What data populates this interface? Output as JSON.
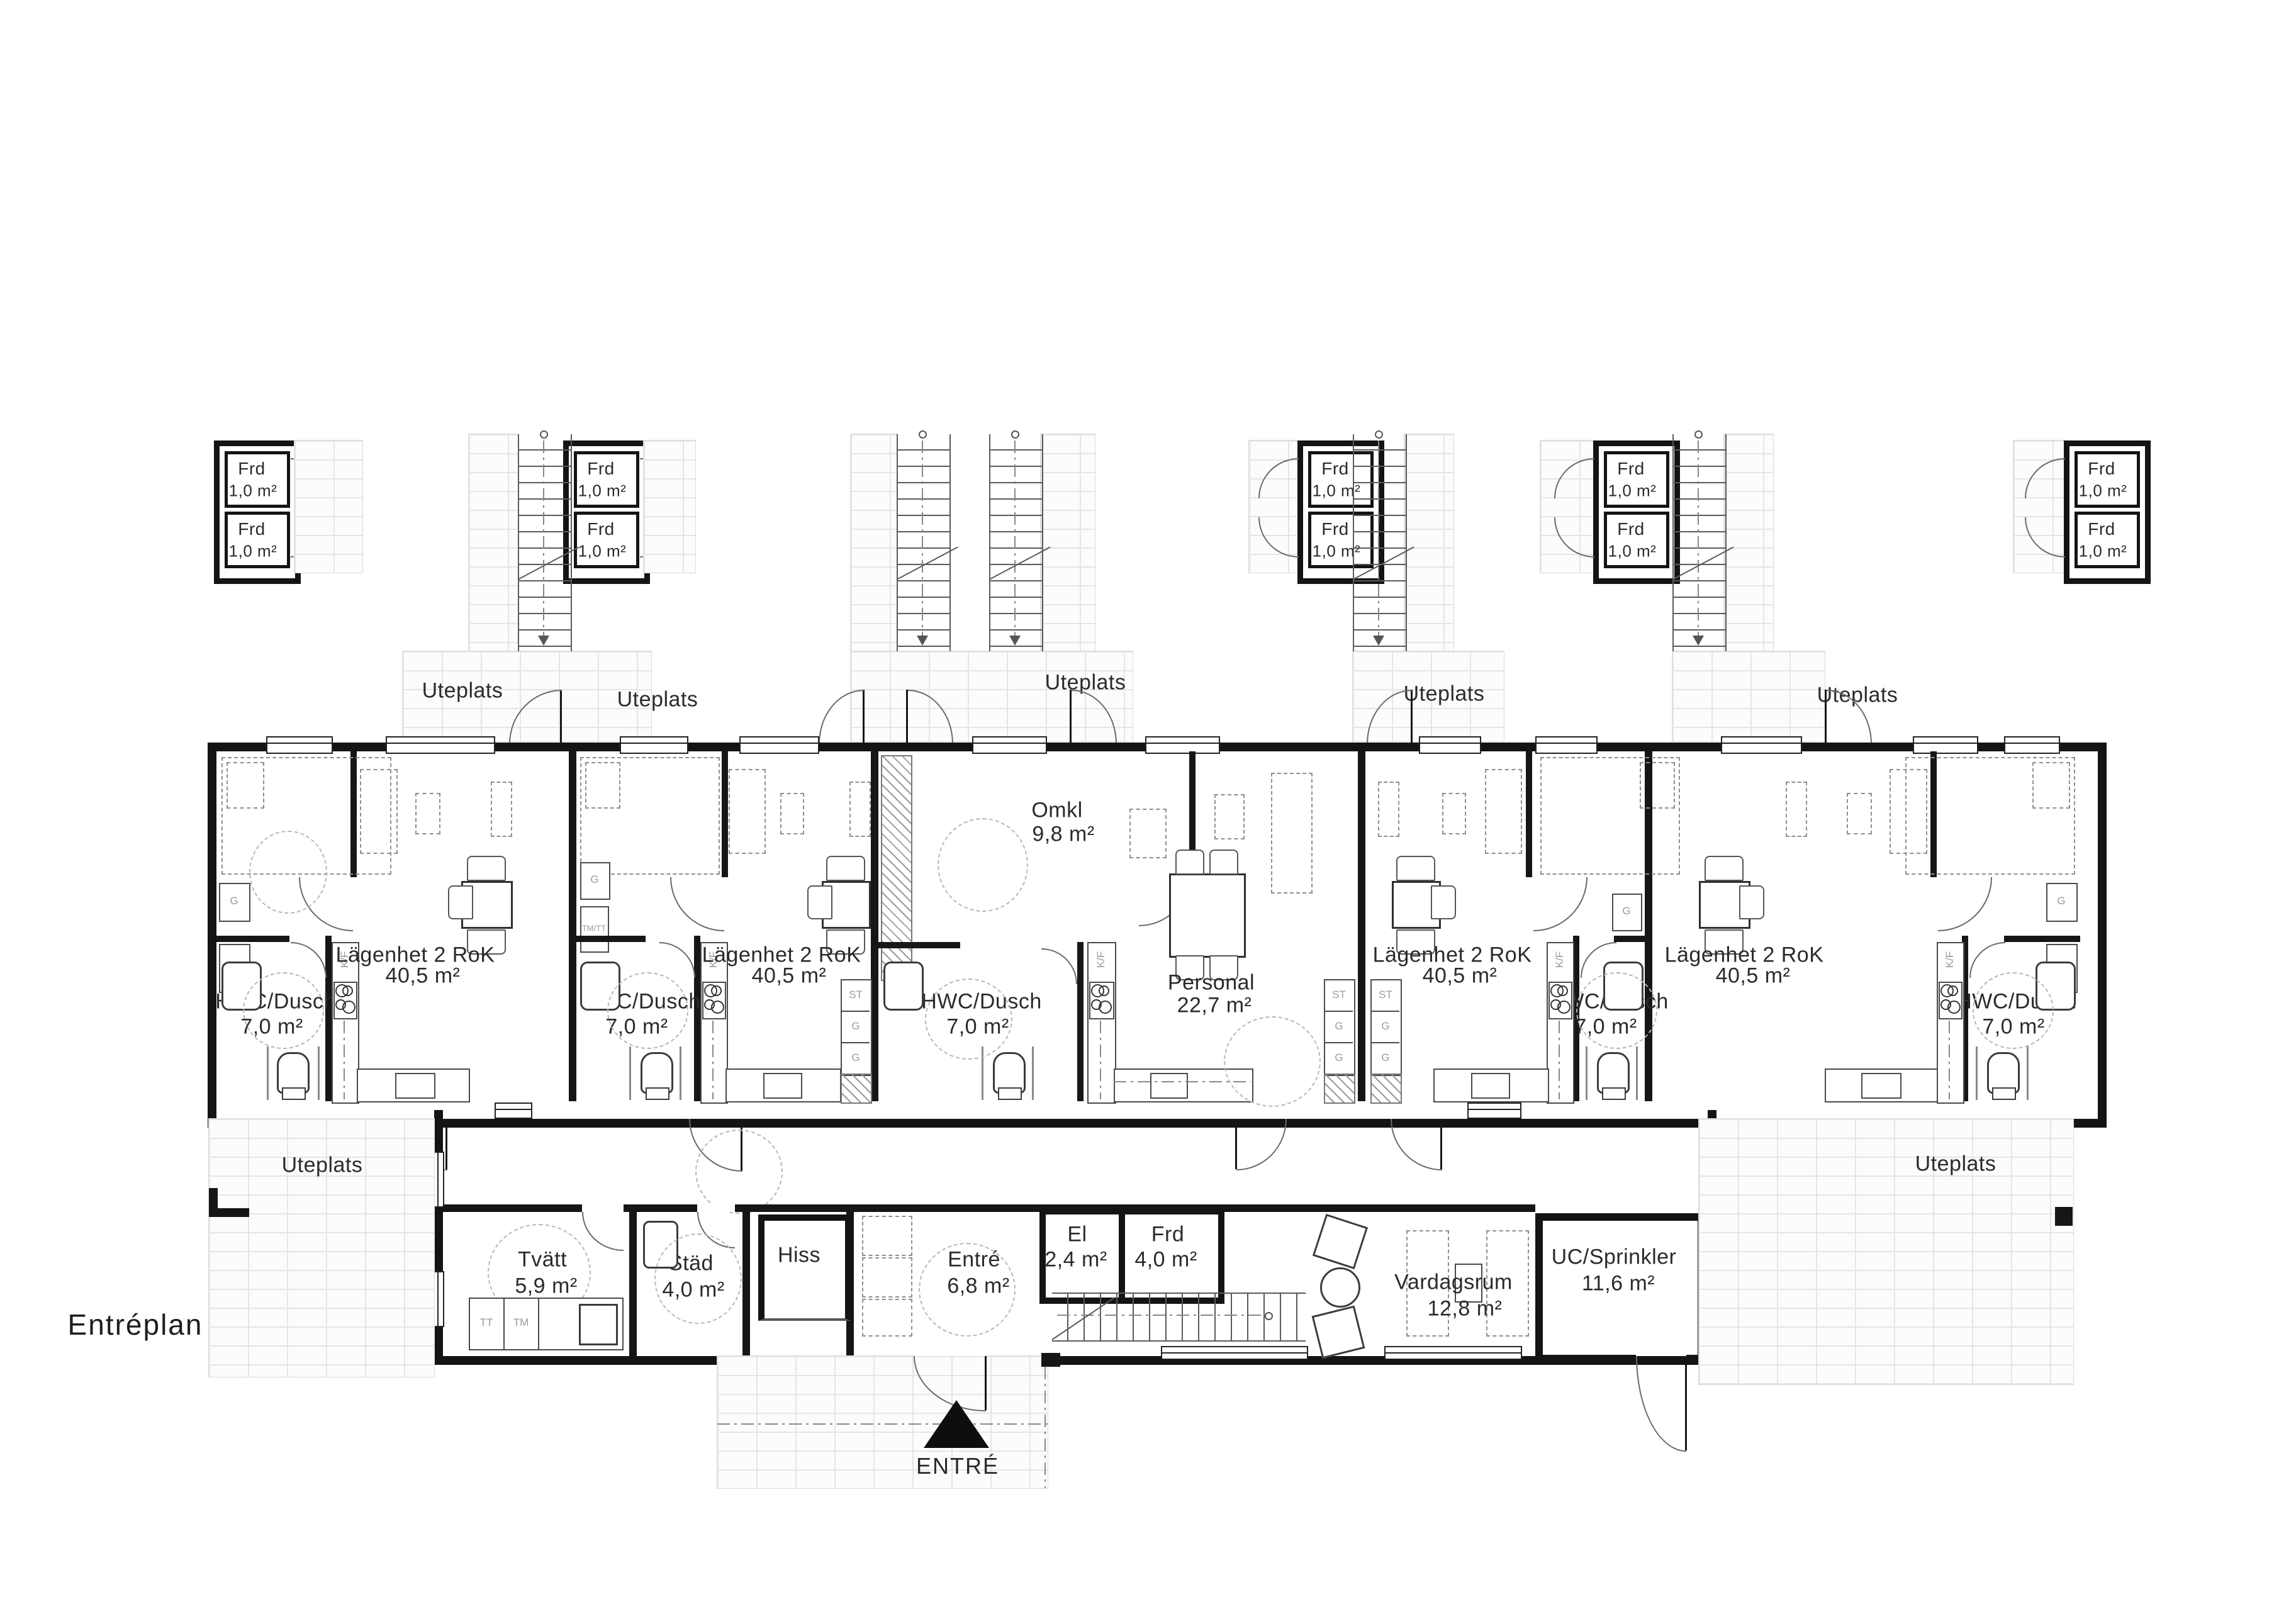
{
  "title": "Entréplan",
  "labels": {
    "uteplats": "Uteplats",
    "entrance_arrow": "ENTRÉ"
  },
  "apartment": {
    "name": "Lägenhet 2 RoK",
    "area": "40,5 m²"
  },
  "rooms": {
    "hwc": {
      "name": "HWC/Dusch",
      "area": "7,0 m²"
    },
    "omkl": {
      "name": "Omkl",
      "area": "9,8 m²"
    },
    "personal": {
      "name": "Personal",
      "area": "22,7 m²"
    },
    "tvatt": {
      "name": "Tvätt",
      "area": "5,9 m²"
    },
    "stad": {
      "name": "Städ",
      "area": "4,0 m²"
    },
    "hiss": {
      "name": "Hiss"
    },
    "entre": {
      "name": "Entré",
      "area": "6,8 m²"
    },
    "el": {
      "name": "El",
      "area": "2,4 m²"
    },
    "frd_room": {
      "name": "Frd",
      "area": "4,0 m²"
    },
    "vardagsrum": {
      "name": "Vardagsrum",
      "area": "12,8 m²"
    },
    "uc": {
      "name": "UC/Sprinkler",
      "area": "11,6 m²"
    }
  },
  "storage_box": {
    "name": "Frd",
    "area": "1,0 m²"
  },
  "fixtures": {
    "wardrobe": "G",
    "washer_tower": "TM/TT",
    "fridge_freezer": "K/F",
    "tall_cabinet": "ST",
    "dryer": "TT",
    "washer": "TM"
  }
}
